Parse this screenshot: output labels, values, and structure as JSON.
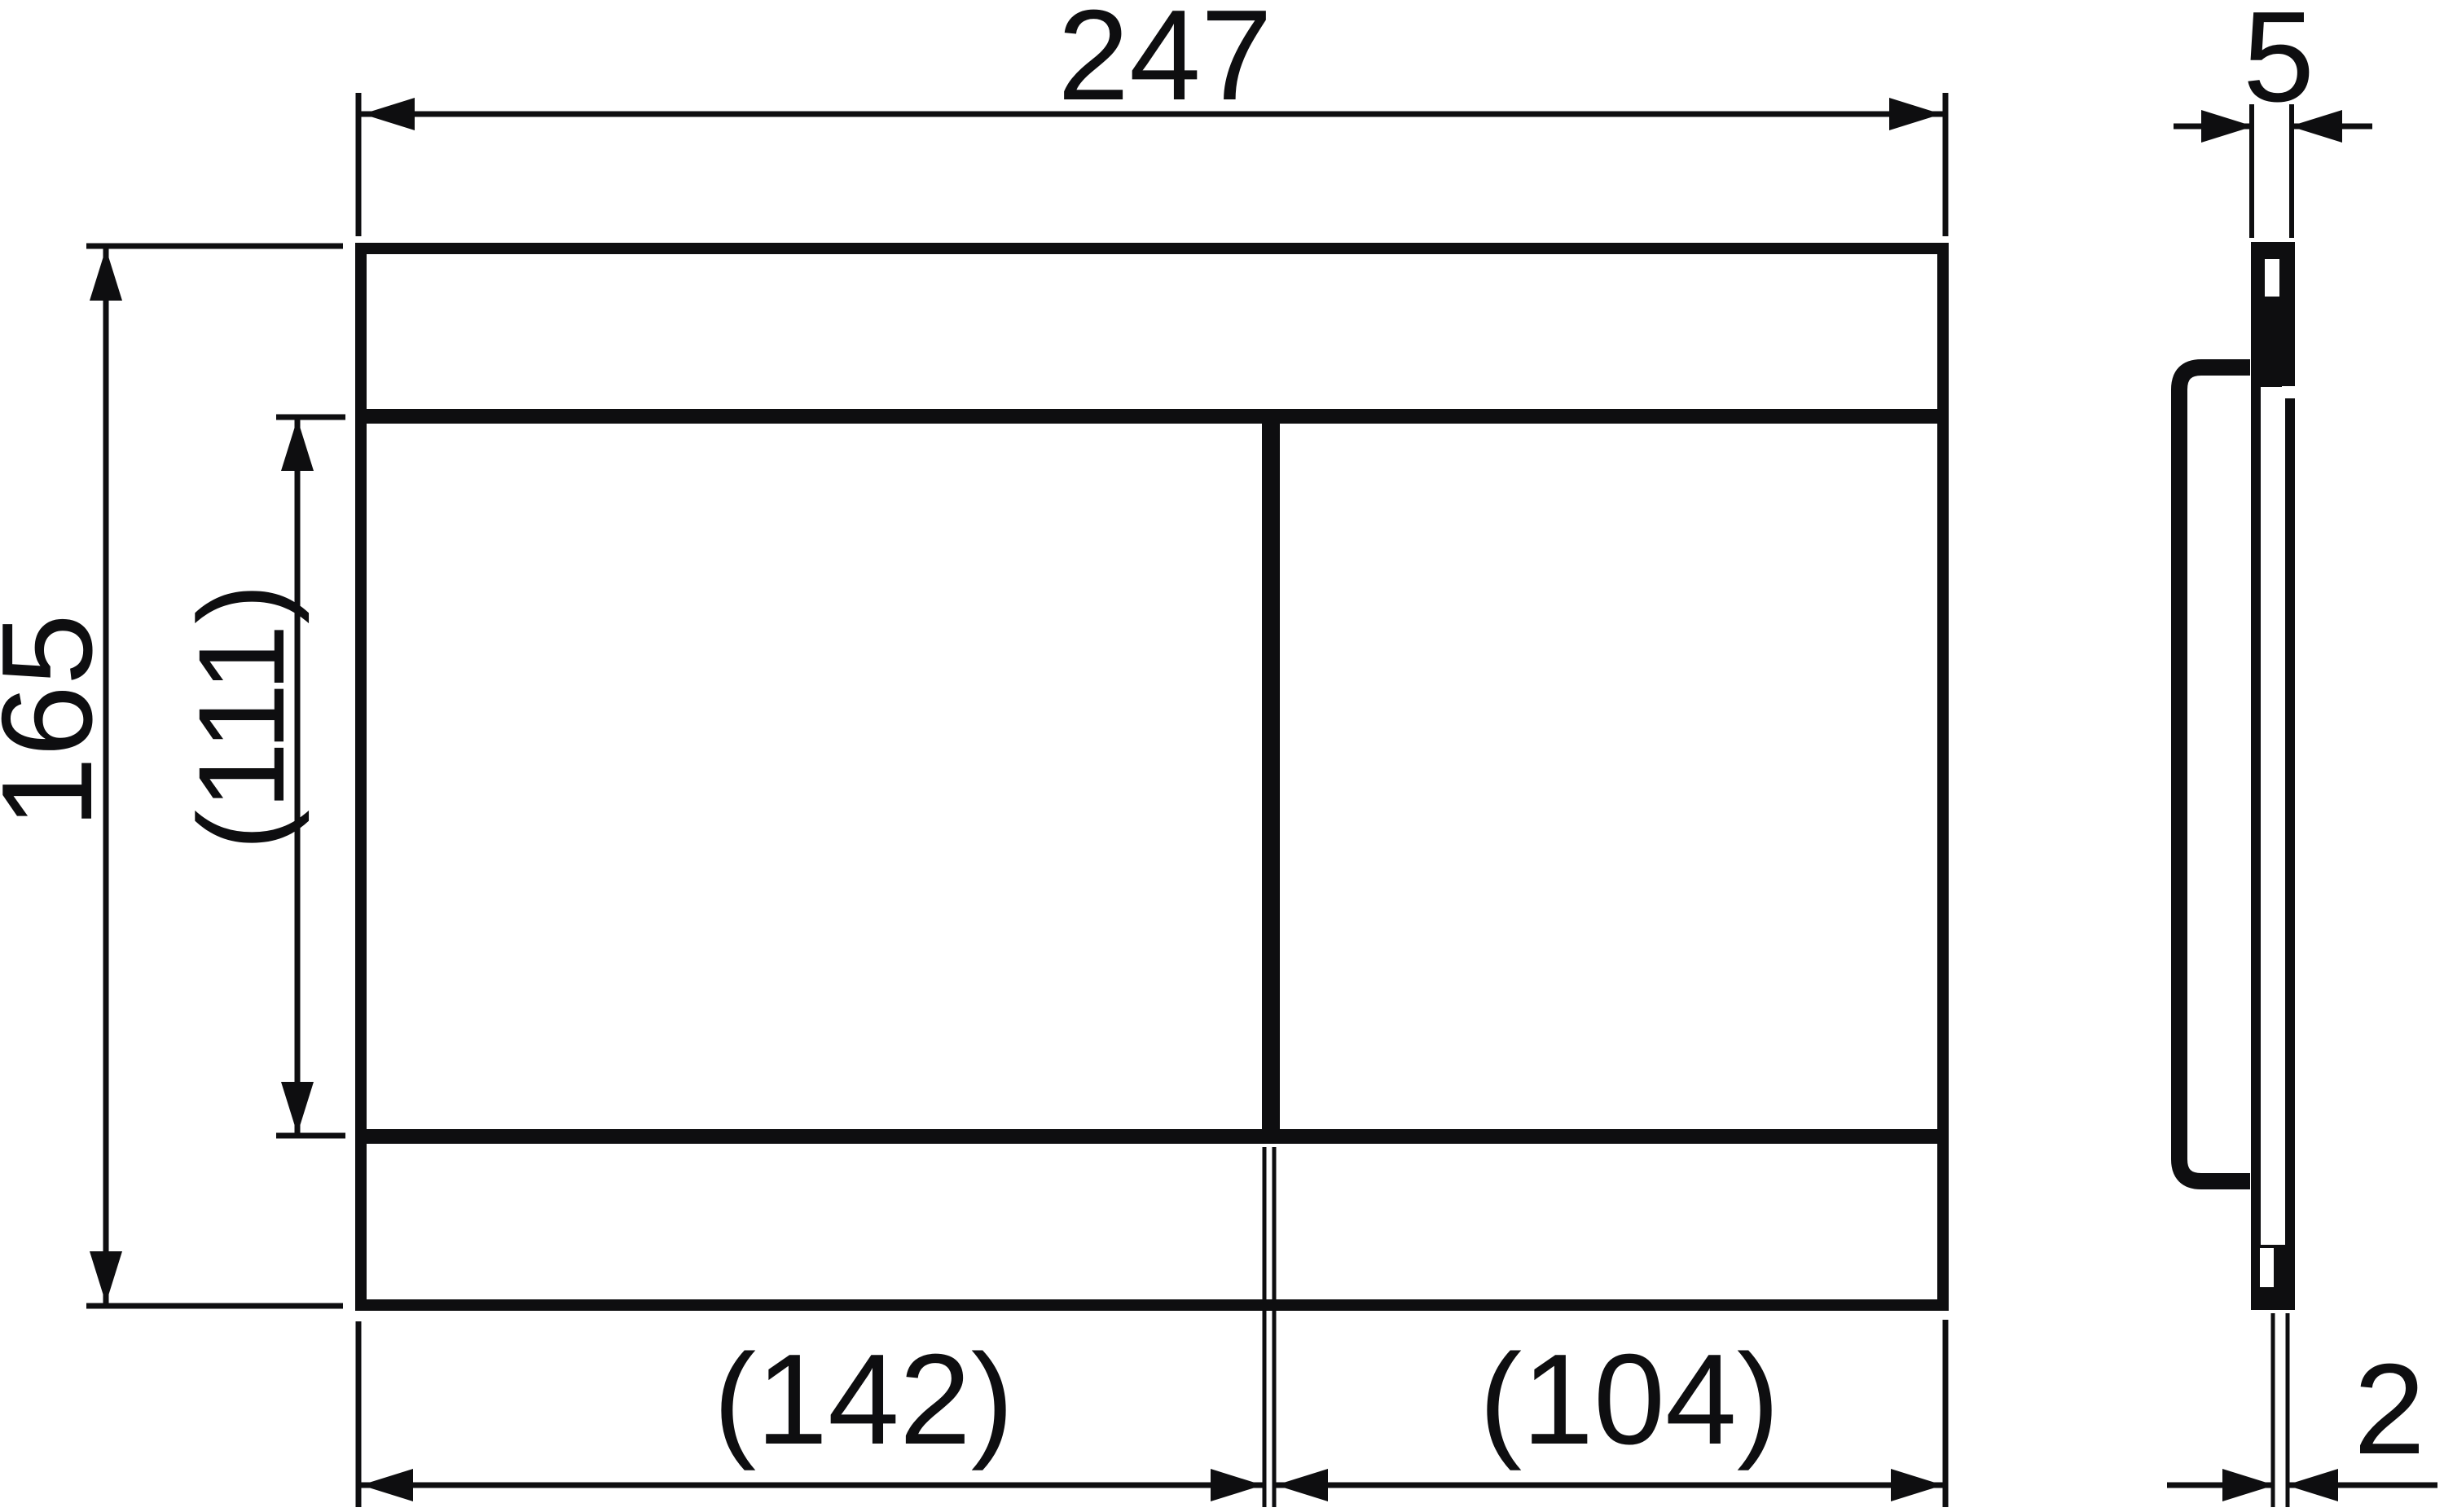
{
  "page": {
    "background_color": "#ffffff",
    "line_color": "#0e0e10"
  },
  "drawing": {
    "kind": "technical-dimension-drawing",
    "subject": "rectangular flush plate with two buttons, front view and side view",
    "units_shown": "mm (numbers only)",
    "labels": {
      "overall_width": "247",
      "overall_height": "165",
      "button_field_height": "(111)",
      "left_button_width": "(142)",
      "right_button_width": "(104)",
      "plate_thickness": "5",
      "rear_offset": "2"
    }
  }
}
